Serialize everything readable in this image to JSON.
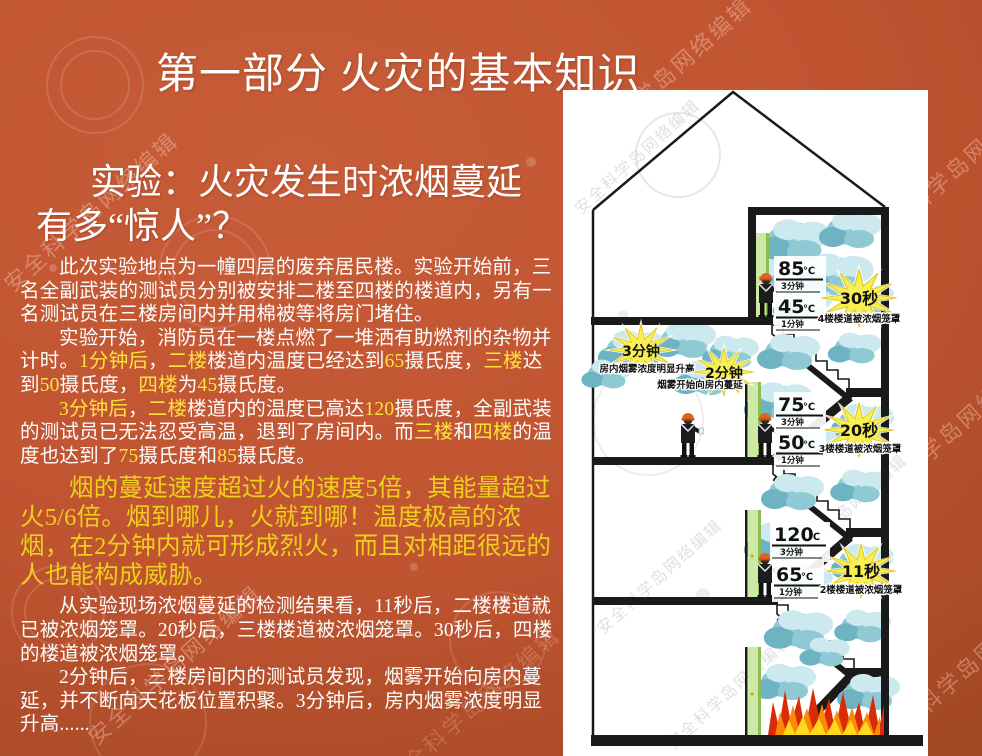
{
  "title": "第一部分  火灾的基本知识",
  "subtitle": "实验：火灾发生时浓烟蔓延有多“惊人”？",
  "paragraphs": [
    {
      "segments": [
        {
          "t": "此次实验地点为一幢四层的废弃居民楼。实验开始前，三名全副武装的测试员分别被安排二楼至四楼的楼道内，另有一名测试员在三楼房间内并用棉被等将房门堵住。"
        }
      ]
    },
    {
      "segments": [
        {
          "t": "实验开始，消防员在一楼点燃了一堆洒有助燃剂的杂物并计时。"
        },
        {
          "t": "1分钟后",
          "hl": true
        },
        {
          "t": "，"
        },
        {
          "t": "二楼",
          "hl": true
        },
        {
          "t": "楼道内温度已经达到"
        },
        {
          "t": "65",
          "hl": true
        },
        {
          "t": "摄氏度，"
        },
        {
          "t": "三楼",
          "hl": true
        },
        {
          "t": "达到"
        },
        {
          "t": "50",
          "hl": true
        },
        {
          "t": "摄氏度，"
        },
        {
          "t": "四楼",
          "hl": true
        },
        {
          "t": "为"
        },
        {
          "t": "45",
          "hl": true
        },
        {
          "t": "摄氏度。"
        }
      ]
    },
    {
      "segments": [
        {
          "t": "3分钟后",
          "hl": true
        },
        {
          "t": "，"
        },
        {
          "t": "二楼",
          "hl": true
        },
        {
          "t": "楼道内的温度已高达"
        },
        {
          "t": "120",
          "hl": true
        },
        {
          "t": "摄氏度，全副武装的测试员已无法忍受高温，退到了房间内。而"
        },
        {
          "t": "三楼",
          "hl": true
        },
        {
          "t": "和"
        },
        {
          "t": "四楼",
          "hl": true
        },
        {
          "t": "的温度也达到了"
        },
        {
          "t": "75",
          "hl": true
        },
        {
          "t": "摄氏度和"
        },
        {
          "t": "85",
          "hl": true
        },
        {
          "t": "摄氏度。"
        }
      ]
    },
    {
      "big": true,
      "segments": [
        {
          "t": "烟的蔓延速度超过火的速度5倍，其能量超过火5/6倍。烟到哪儿，火就到哪！温度极高的浓烟，在2分钟内就可形成烈火，而且对相距很远的人也能构成威胁。"
        }
      ]
    },
    {
      "segments": [
        {
          "t": "从实验现场浓烟蔓延的检测结果看，11秒后，二楼楼道就已被浓烟笼罩。20秒后，三楼楼道被浓烟笼罩。30秒后，四楼的楼道被浓烟笼罩。"
        }
      ]
    },
    {
      "segments": [
        {
          "t": "2分钟后，三楼房间内的测试员发现，烟雾开始向房内蔓延，并不断向天花板位置积聚。3分钟后，房内烟雾浓度明显升高......"
        }
      ]
    }
  ],
  "diagram": {
    "temps": [
      {
        "value": "85",
        "unit": "℃",
        "time": "3分钟"
      },
      {
        "value": "45",
        "unit": "℃",
        "time": "1分钟"
      },
      {
        "value": "75",
        "unit": "℃",
        "time": "3分钟"
      },
      {
        "value": "50",
        "unit": "℃",
        "time": "1分钟"
      },
      {
        "value": "120",
        "unit": "℃",
        "time": "3分钟"
      },
      {
        "value": "65",
        "unit": "℃",
        "time": "1分钟"
      }
    ],
    "bursts": [
      {
        "label": "30秒",
        "caption": "4楼楼道被浓烟笼罩"
      },
      {
        "label": "20秒",
        "caption": "3楼楼道被浓烟笼罩"
      },
      {
        "label": "11秒",
        "caption": "2楼楼道被浓烟笼罩"
      },
      {
        "label": "3分钟",
        "caption": "房内烟雾浓度明显升高"
      },
      {
        "label": "2分钟",
        "caption": "烟雾开始向房内蔓延"
      }
    ]
  },
  "watermark": "安全科学岛网络编辑",
  "colors": {
    "background_rust": "#bd5230",
    "highlight_yellow": "#ffe33c",
    "emphasis_yellow": "#eecf1b",
    "smoke_teal": "#8fc9d4",
    "burst_yellow": "#f8ef52",
    "door_green": "#cde9a6",
    "helmet_orange": "#e8611c",
    "fire_red": "#d92b05",
    "fire_orange": "#fa8b0a",
    "fire_yellow": "#ffd91c"
  }
}
